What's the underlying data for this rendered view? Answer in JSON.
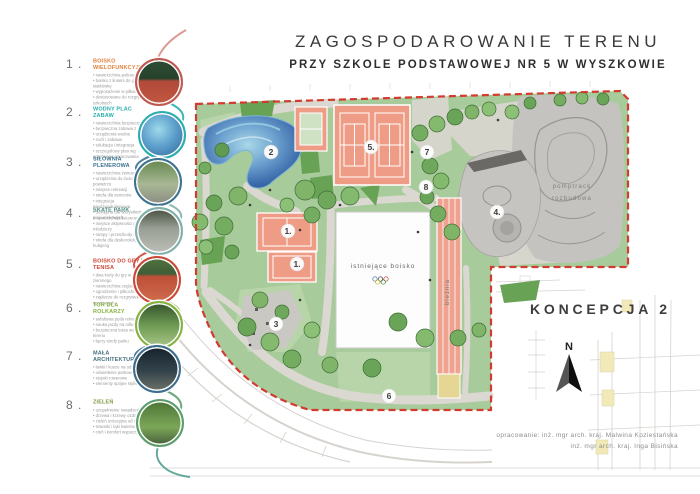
{
  "title": {
    "line1": "ZAGOSPODAROWANIE TERENU",
    "line2": "PRZY SZKOLE PODSTAWOWEJ NR 5 W WYSZKOWIE"
  },
  "concept_label": "KONCEPCJA 2",
  "north_label": "N",
  "credits": {
    "line1": "opracowanie: inż. mgr arch. kraj. Malwina Koziestańska",
    "line2": "inż. mgr arch. kraj. Inga Bisińska"
  },
  "plan": {
    "labels": {
      "existing_field": "istniejące boisko",
      "running_track": "bieżnia",
      "pumptrack_line1": "pomptrack",
      "pumptrack_line2": "rozbudowa"
    },
    "markers": [
      "1.",
      "1.",
      "2",
      "3",
      "4.",
      "5.",
      "6",
      "7",
      "8"
    ]
  },
  "legend": {
    "items": [
      {
        "num": "1 .",
        "heading": "BOISKO WIELOFUNKCYJNE",
        "color": "#e0833c",
        "ring": "#c05a50",
        "bullets": [
          "nawierzchnia poliuretanowa",
          "boisko z liniami do gry w siatkówkę",
          "wyposażenie w piłkochwyty",
          "dostosowane do rozgrywek szkolnych"
        ]
      },
      {
        "num": "2 .",
        "heading": "WODNY PLAC ZABAW",
        "color": "#2aaeae",
        "ring": "#2aaeae",
        "bullets": [
          "nawierzchnia bezpieczna",
          "bezpieczna zabawa z wodą",
          "urządzenia wodne",
          "ruch i zabawa",
          "edukacja i integracja",
          "szczegółowy plan wg odrębnego opracowania"
        ]
      },
      {
        "num": "3 .",
        "heading": "SIŁOWNIA PLENEROWA",
        "color": "#3c7391",
        "ring": "#3c7391",
        "bullets": [
          "nawierzchnia żwirowa",
          "urządzenia do ćwiczeń na powietrzu",
          "miejsce rekreacji",
          "strefa dla seniorów",
          "integracja międzypokoleniowa",
          "dostępna dla wszystkich grup wiekowych"
        ]
      },
      {
        "num": "4 .",
        "heading": "SKATE PARK",
        "color": "#4e8b84",
        "ring": "#7fb0ab",
        "bullets": [
          "nawierzchnia betonowa",
          "miejsce aktywności dla młodzieży",
          "rampy i przeszkody do jazdy",
          "strefa dla deskorolek, rolek i hulajnóg"
        ]
      },
      {
        "num": "5 .",
        "heading": "BOISKO DO GRY W TENISA",
        "color": "#cc4837",
        "ring": "#cc4837",
        "bullets": [
          "dwa korty do gry w tenisa ziemnego",
          "nawierzchnia ceglasta",
          "ogrodzenie i piłkochwyty",
          "zaplecze do rozgrywek sportowych"
        ]
      },
      {
        "num": "6 .",
        "heading": "TOR DLA ROLKARZY",
        "color": "#86b23f",
        "ring": "#86b23f",
        "bullets": [
          "asfaltowa pętla rekreacyjna",
          "nauka jazdy na rolkach",
          "bezpieczna trasa wokół terenu",
          "łączy strefy parku"
        ]
      },
      {
        "num": "7 .",
        "heading": "MAŁA ARCHITEKTURA",
        "color": "#44707d",
        "ring": "#3c6e8f",
        "bullets": [
          "ławki i kosze na odpady",
          "oświetlenie parkowe",
          "stojaki rowerowe",
          "elementy spójne stylistycznie"
        ]
      },
      {
        "num": "8 .",
        "heading": "ZIELEŃ",
        "color": "#7f9a3f",
        "ring": "#5d9e6e",
        "bullets": [
          "uzupełnienie nasadzeń",
          "drzewa i krzewy ozdobne",
          "zieleń izolacyjna od ulicy",
          "trawniki i łąki kwietne",
          "cień i komfort wypoczynku"
        ]
      }
    ]
  },
  "colors": {
    "site_green": "#a8cb9b",
    "court_salmon": "#ef9c86",
    "boundary_red": "#d23b2f",
    "water_blue": "#3f7fb5",
    "path_gray": "#dbd7d1",
    "concrete_gray": "#c4c3c0"
  }
}
